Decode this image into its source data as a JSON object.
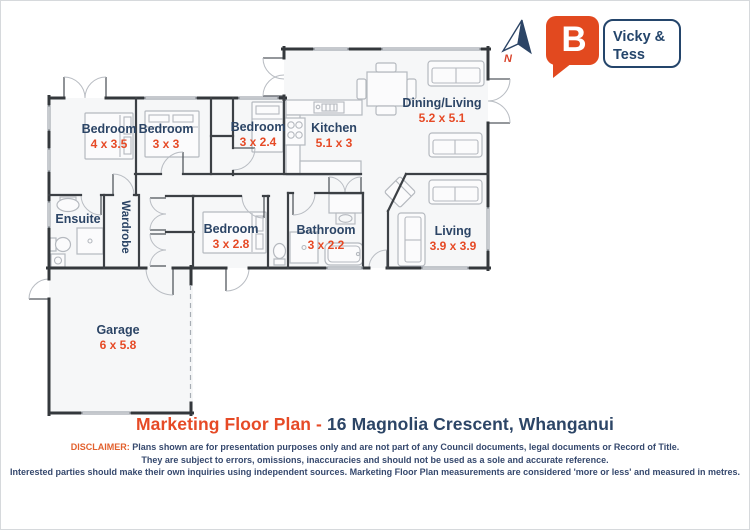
{
  "brand": {
    "logo_letter": "B",
    "name_line1": "Vicky &",
    "name_line2": "Tess"
  },
  "compass": {
    "label": "N"
  },
  "rooms": [
    {
      "name": "Bedroom",
      "dims": "4 x 3.5"
    },
    {
      "name": "Bedroom",
      "dims": "3 x 3"
    },
    {
      "name": "Bedroom",
      "dims": "3 x 2.4"
    },
    {
      "name": "Kitchen",
      "dims": "5.1 x 3"
    },
    {
      "name": "Dining/Living",
      "dims": "5.2 x 5.1"
    },
    {
      "name": "Ensuite",
      "dims": ""
    },
    {
      "name": "Wardrobe",
      "dims": ""
    },
    {
      "name": "Bedroom",
      "dims": "3 x 2.8"
    },
    {
      "name": "Bathroom",
      "dims": "3 x 2.2"
    },
    {
      "name": "Living",
      "dims": "3.9 x 3.9"
    },
    {
      "name": "Garage",
      "dims": "6 x 5.8"
    }
  ],
  "footer": {
    "title_highlight": "Marketing Floor Plan -",
    "title_rest": "16 Magnolia Crescent, Whanganui",
    "disclaimer_label": "DISCLAIMER:",
    "disclaimer_line1": "Plans shown are for presentation purposes only and are not part of any Council documents, legal documents or Record of Title.",
    "disclaimer_line2": "They are subject to errors, omissions, inaccuracies and should not be used as a sole and accurate reference.",
    "disclaimer_line3": "Interested parties should make their own inquiries using independent sources. Marketing Floor Plan measurements are considered 'more or less' and measured in metres."
  },
  "colors": {
    "accent_orange": "#e64a26",
    "logo_orange": "#e2491f",
    "navy": "#2c4566",
    "wall_dark": "#34383c",
    "light_gray": "#b5b9bf"
  }
}
